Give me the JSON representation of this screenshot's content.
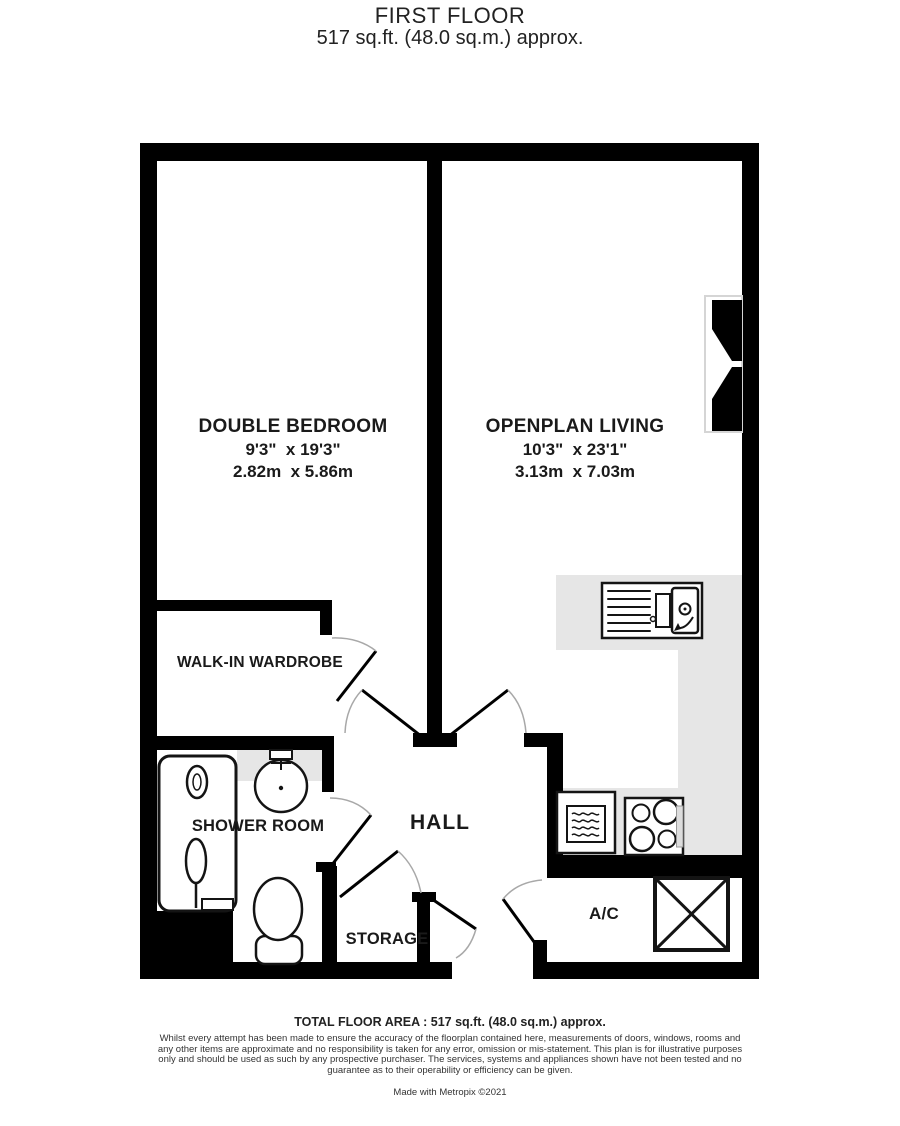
{
  "header": {
    "title": "FIRST FLOOR",
    "subtitle": "517 sq.ft. (48.0 sq.m.) approx."
  },
  "rooms": {
    "bedroom": {
      "name": "DOUBLE BEDROOM",
      "imperial": "9'3\"  x 19'3\"",
      "metric": "2.82m  x 5.86m"
    },
    "living": {
      "name": "OPENPLAN LIVING",
      "imperial": "10'3\"  x 23'1\"",
      "metric": "3.13m  x 7.03m"
    },
    "wardrobe": {
      "name": "WALK-IN WARDROBE"
    },
    "shower": {
      "name": "SHOWER ROOM"
    },
    "hall": {
      "name": "HALL"
    },
    "storage": {
      "name": "STORAGE"
    },
    "ac": {
      "name": "A/C"
    }
  },
  "footer": {
    "total": "TOTAL FLOOR AREA : 517 sq.ft. (48.0 sq.m.) approx.",
    "disclaimer": "Whilst every attempt has been made to ensure the accuracy of the floorplan contained here, measurements of doors, windows, rooms and any other items are approximate and no responsibility is taken for any error, omission or mis-statement. This plan is for illustrative purposes only and should be used as such by any prospective purchaser. The services, systems and appliances shown have not been tested and no guarantee as to their operability or efficiency can be given.",
    "credit": "Made with Metropix ©2021"
  },
  "icons": {
    "fixtures": [
      "kitchen-sink",
      "hob",
      "microwave",
      "shower",
      "basin",
      "toilet",
      "ac-unit",
      "window"
    ]
  },
  "colors": {
    "wall": "#000000",
    "counter": "#e6e6e6",
    "door_arc": "#a8a8a8",
    "fixture_stroke": "#141414"
  }
}
